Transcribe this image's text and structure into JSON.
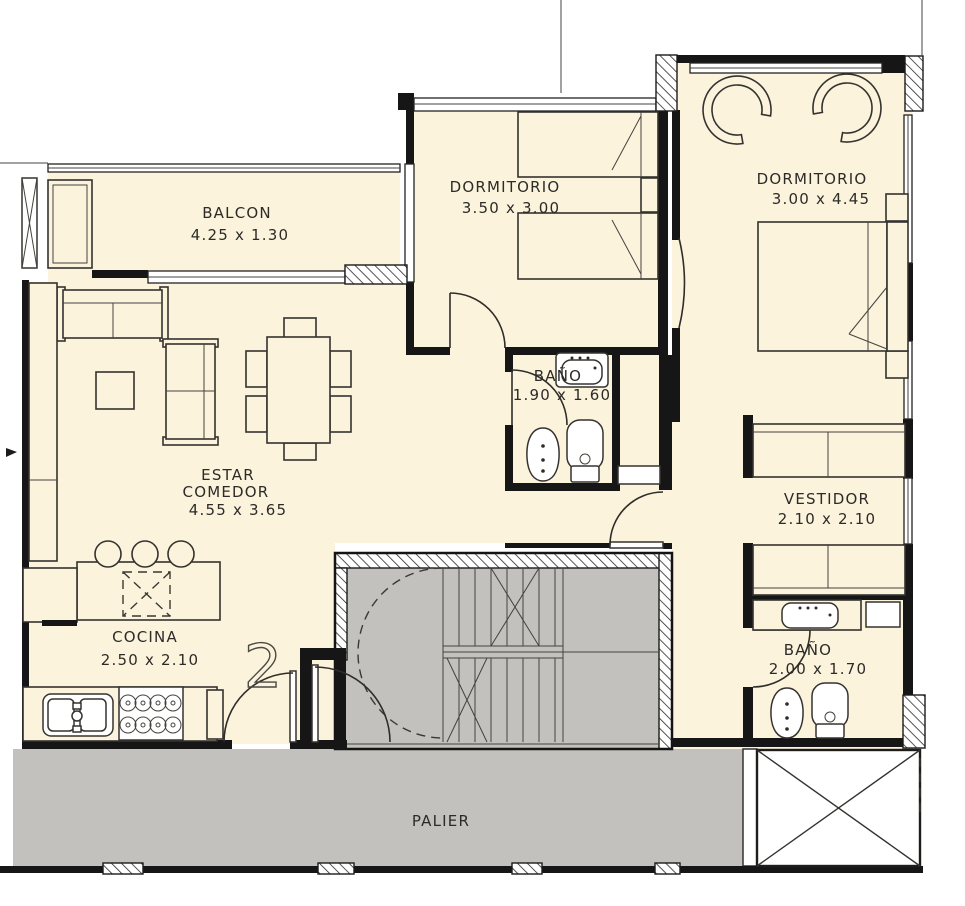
{
  "unit_number": "2",
  "rooms": {
    "balcon": {
      "name": "BALCON",
      "dims": "4.25 x 1.30"
    },
    "dormitorio1": {
      "name": "DORMITORIO",
      "dims": "3.50 x 3.00"
    },
    "dormitorio2": {
      "name": "DORMITORIO",
      "dims": "3.00 x 4.45"
    },
    "bano1": {
      "name": "BAÑO",
      "dims": "1.90 x 1.60"
    },
    "estar": {
      "line1": "ESTAR",
      "line2": "COMEDOR",
      "dims": "4.55 x 3.65"
    },
    "vestidor": {
      "name": "VESTIDOR",
      "dims": "2.10 x 2.10"
    },
    "cocina": {
      "name": "COCINA",
      "dims": "2.50 x 2.10"
    },
    "bano2": {
      "name": "BAÑO",
      "dims": "2.00 x 1.70"
    },
    "palier": {
      "name": "PALIER"
    }
  },
  "colors": {
    "floor": "#fbf3dc",
    "common": "#c2c1bd",
    "wall": "#161616"
  }
}
